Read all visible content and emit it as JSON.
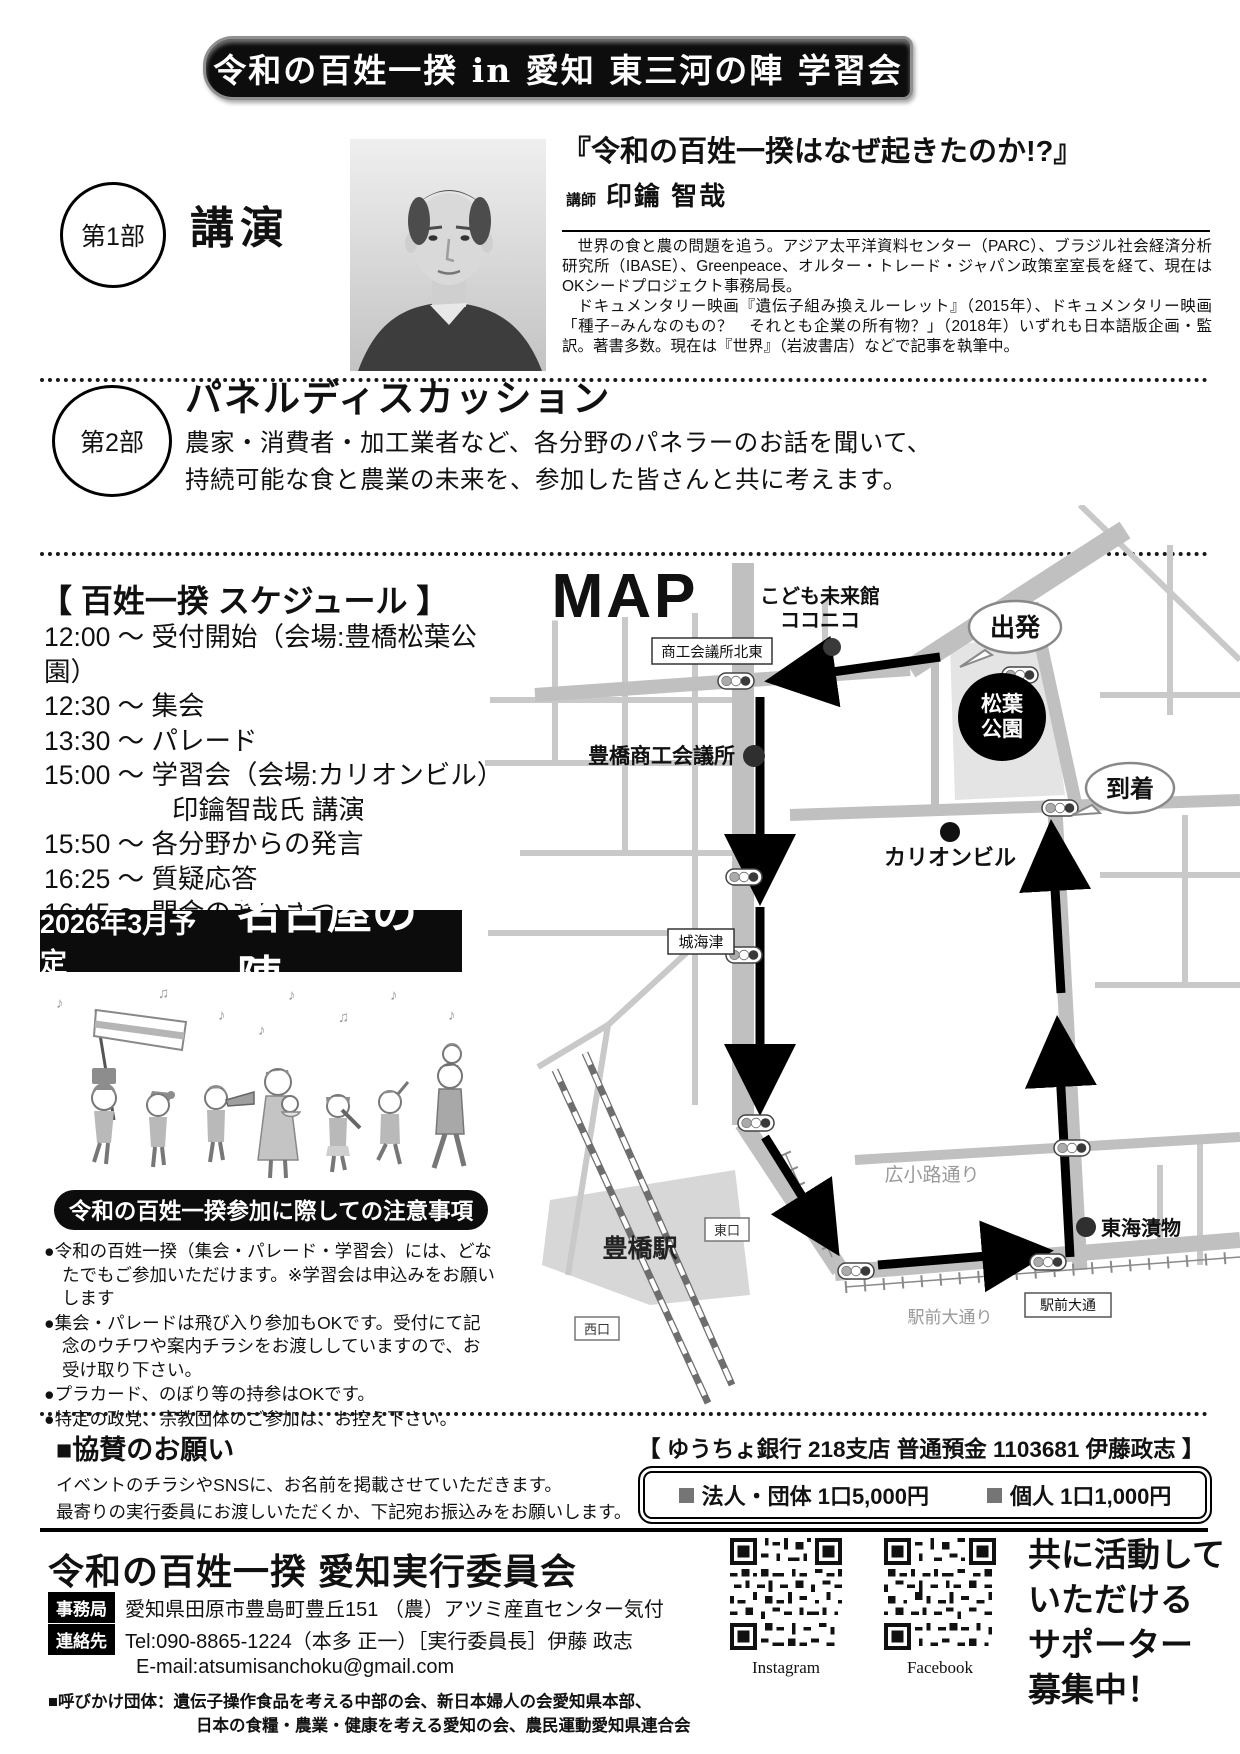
{
  "banner": {
    "title": "令和の百姓一揆 in 愛知 東三河の陣 学習会"
  },
  "part1": {
    "badge": "第1部",
    "heading": "講演",
    "lecture_title": "『令和の百姓一揆はなぜ起きたのか!?』",
    "lecturer_label": "講師",
    "lecturer_name": "印鑰  智哉",
    "bio1": "世界の食と農の問題を追う。アジア太平洋資料センター（PARC）、ブラジル社会経済分析研究所（IBASE）、Greenpeace、オルター・トレード・ジャパン政策室室長を経て、現在はOKシードプロジェクト事務局長。",
    "bio2": "ドキュメンタリー映画『遺伝子組み換えルーレット』（2015年）、ドキュメンタリー映画「種子−みんなのもの？　それとも企業の所有物？」（2018年）いずれも日本語版企画・監訳。著書多数。現在は『世界』（岩波書店）などで記事を執筆中。"
  },
  "part2": {
    "badge": "第2部",
    "heading": "パネルディスカッション",
    "line1": "農家・消費者・加工業者など、各分野のパネラーのお話を聞いて、",
    "line2": "持続可能な食と農業の未来を、参加した皆さんと共に考えます。"
  },
  "schedule": {
    "heading": "【 百姓一揆 スケジュール 】",
    "items": [
      "12:00 〜 受付開始（会場:豊橋松葉公園）",
      "12:30 〜 集会",
      "13:30 〜 パレード",
      "15:00 〜 学習会（会場:カリオンビル）",
      "印鑰智哉氏 講演",
      "15:50 〜 各分野からの発言",
      "16:25 〜 質疑応答",
      "16:45 〜 閉会のあいさつ"
    ]
  },
  "nagoya": {
    "date": "2026年3月予定",
    "name": "名古屋の陣"
  },
  "notice": {
    "heading": "令和の百姓一揆参加に際しての注意事項",
    "items": [
      "●令和の百姓一揆（集会・パレード・学習会）には、どなたでもご参加いただけます。※学習会は申込みをお願いします",
      "●集会・パレードは飛び入り参加もOKです。受付にて記念のウチワや案内チラシをお渡ししていますので、お受け取り下さい。",
      "●プラカード、のぼり等の持参はOKです。",
      "●特定の政党、宗教団体のご参加は、お控え下さい。"
    ]
  },
  "map": {
    "logo": "MAP",
    "labels": {
      "kodomo1": "こども未来館",
      "kodomo2": "ココニコ",
      "shoko_box": "商工会議所北東",
      "shoko": "豊橋商工会議所",
      "depart": "出発",
      "park1": "松葉",
      "park2": "公園",
      "arrive": "到着",
      "carillon": "カリオンビル",
      "shirokaizu": "城海津",
      "hirokoji": "広小路通り",
      "tokai": "東海漬物",
      "station": "豊橋駅",
      "east_exit": "東口",
      "west_exit": "西口",
      "ekimae_street": "駅前大通り",
      "ekimae_box": "駅前大通"
    }
  },
  "sponsor": {
    "heading": "■協賛のお願い",
    "line1": "イベントのチラシやSNSに、お名前を掲載させていただきます。",
    "line2": "最寄りの実行委員にお渡しいただくか、下記宛お振込みをお願いします。",
    "bank": "【 ゆうちょ銀行 218支店 普通預金 1103681 伊藤政志 】",
    "fee_corporate": "法人・団体 1口5,000円",
    "fee_individual": "個人 1口1,000円"
  },
  "footer": {
    "org_name": "令和の百姓一揆 愛知実行委員会",
    "office_label": "事務局",
    "office_value": "愛知県田原市豊島町豊丘151 （農）アツミ産直センター気付",
    "contact_label": "連絡先",
    "contact_value": "Tel:090-8865-1224（本多 正一）［実行委員長］伊藤 政志",
    "email": "E-mail:atsumisanchoku@gmail.com",
    "call1": "■呼びかけ団体：遺伝子操作食品を考える中部の会、新日本婦人の会愛知県本部、",
    "call2": "日本の食糧・農業・健康を考える愛知の会、農民運動愛知県連合会",
    "qr_instagram": "Instagram",
    "qr_facebook": "Facebook",
    "supporter": [
      "共に活動して",
      "いただける",
      "サポーター",
      "募集中！"
    ]
  }
}
